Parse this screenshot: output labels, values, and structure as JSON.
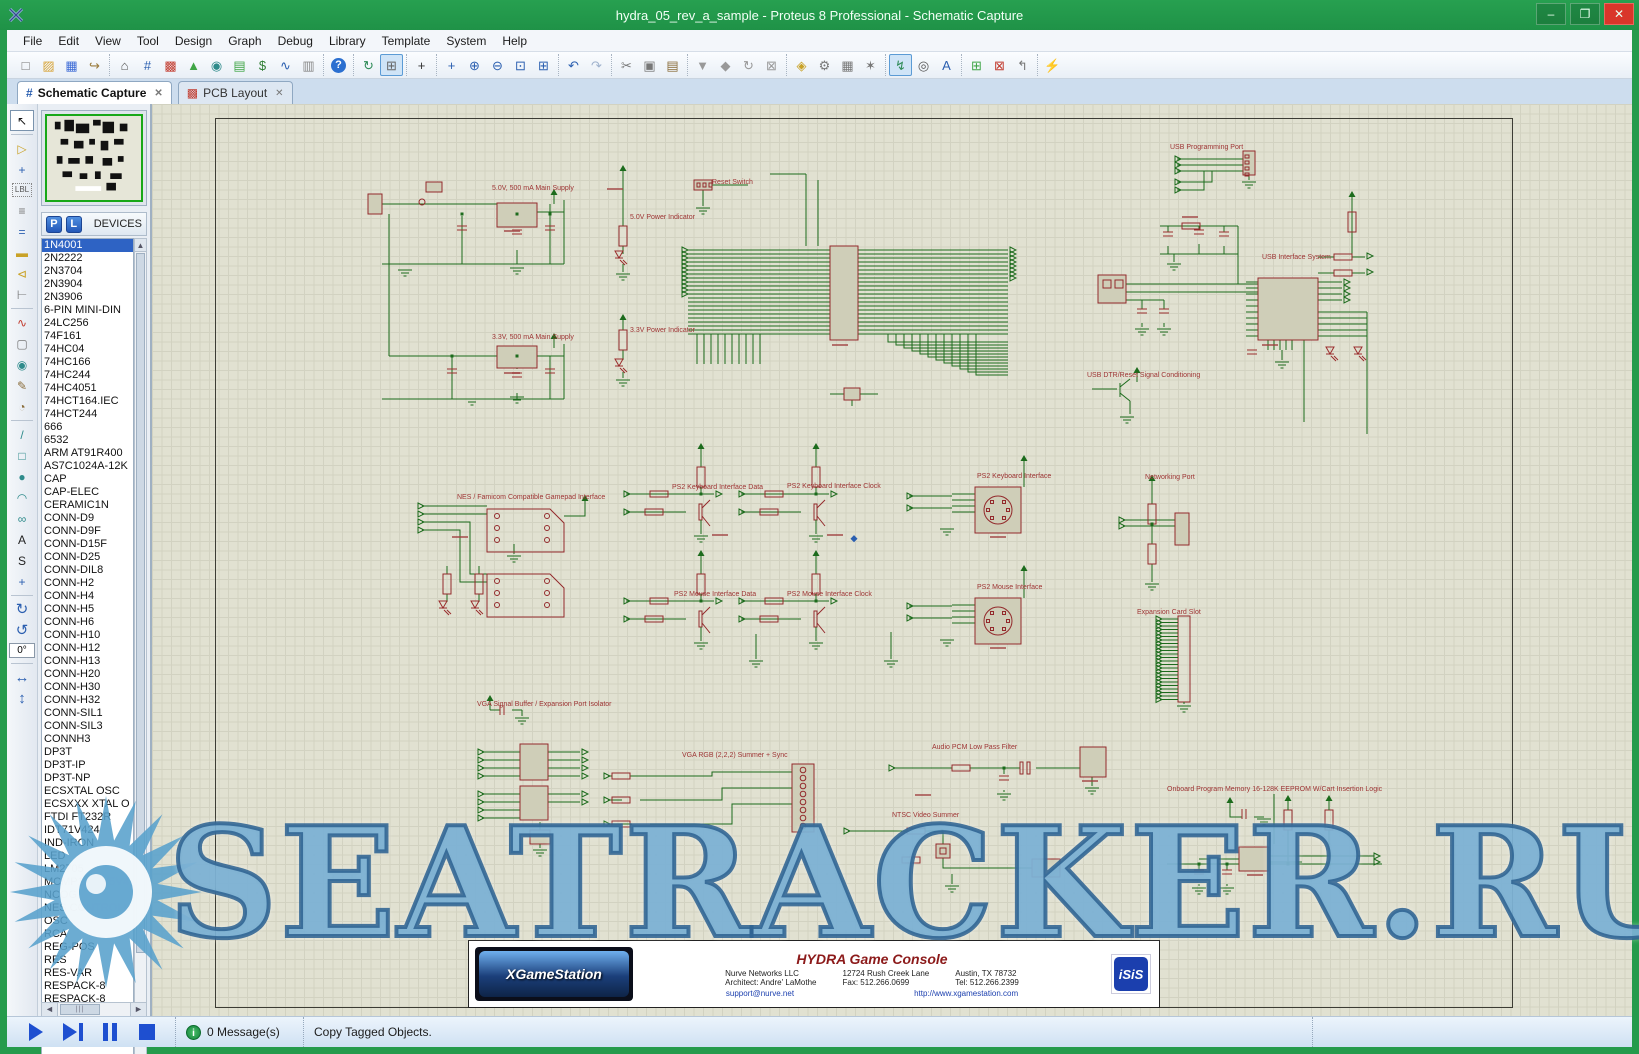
{
  "window": {
    "title": "hydra_05_rev_a_sample - Proteus 8 Professional - Schematic Capture",
    "minimize_glyph": "–",
    "maximize_glyph": "❐",
    "close_glyph": "✕"
  },
  "menu_items": [
    "File",
    "Edit",
    "View",
    "Tool",
    "Design",
    "Graph",
    "Debug",
    "Library",
    "Template",
    "System",
    "Help"
  ],
  "toolbar_groups": [
    {
      "icons": [
        {
          "name": "new-project-icon",
          "glyph": "□",
          "color": "#777"
        },
        {
          "name": "open-project-icon",
          "glyph": "▨",
          "color": "#d8a63c"
        },
        {
          "name": "save-project-icon",
          "glyph": "▦",
          "color": "#3d6bd6"
        },
        {
          "name": "import-project-icon",
          "glyph": "↪",
          "color": "#9a7b3c"
        }
      ]
    },
    {
      "icons": [
        {
          "name": "home-icon",
          "glyph": "⌂",
          "color": "#555"
        },
        {
          "name": "schematic-capture-icon",
          "glyph": "#",
          "color": "#2b5fb0"
        },
        {
          "name": "pcb-layout-icon",
          "glyph": "▩",
          "color": "#c23b2e"
        },
        {
          "name": "3d-visualizer-icon",
          "glyph": "▲",
          "color": "#3fa546"
        },
        {
          "name": "gerber-viewer-icon",
          "glyph": "◉",
          "color": "#2e8b8b"
        },
        {
          "name": "bom-icon",
          "glyph": "▤",
          "color": "#3fa546"
        },
        {
          "name": "bom-cost-icon",
          "glyph": "$",
          "color": "#2e7d32"
        },
        {
          "name": "simulation-icon",
          "glyph": "∿",
          "color": "#2b5fb0"
        },
        {
          "name": "design-explorer-icon",
          "glyph": "▥",
          "color": "#888"
        }
      ]
    },
    {
      "icons": [
        {
          "name": "help-icon",
          "glyph": "?",
          "color": "#fff",
          "help": true
        }
      ]
    },
    {
      "icons": [
        {
          "name": "redraw-icon",
          "glyph": "↻",
          "color": "#2e8b57"
        },
        {
          "name": "grid-toggle-icon",
          "glyph": "⊞",
          "color": "#666",
          "pressed": true
        }
      ]
    },
    {
      "icons": [
        {
          "name": "origin-icon",
          "glyph": "+",
          "color": "#333"
        }
      ]
    },
    {
      "icons": [
        {
          "name": "pan-icon",
          "glyph": "+",
          "color": "#2b5fb0"
        },
        {
          "name": "zoom-in-icon",
          "glyph": "⊕",
          "color": "#2b5fb0"
        },
        {
          "name": "zoom-out-icon",
          "glyph": "⊖",
          "color": "#2b5fb0"
        },
        {
          "name": "zoom-area-icon",
          "glyph": "⊡",
          "color": "#2b5fb0"
        },
        {
          "name": "zoom-all-icon",
          "glyph": "⊞",
          "color": "#2b5fb0"
        }
      ]
    },
    {
      "icons": [
        {
          "name": "undo-icon",
          "glyph": "↶",
          "color": "#2b5fb0"
        },
        {
          "name": "redo-icon",
          "glyph": "↷",
          "color": "#9fb2cd"
        }
      ]
    },
    {
      "icons": [
        {
          "name": "cut-icon",
          "glyph": "✂",
          "color": "#777"
        },
        {
          "name": "copy-icon",
          "glyph": "▣",
          "color": "#777"
        },
        {
          "name": "paste-icon",
          "glyph": "▤",
          "color": "#8a6d3b"
        }
      ]
    },
    {
      "icons": [
        {
          "name": "block-copy-icon",
          "glyph": "▼",
          "color": "#999"
        },
        {
          "name": "block-move-icon",
          "glyph": "◆",
          "color": "#999"
        },
        {
          "name": "block-rotate-icon",
          "glyph": "↻",
          "color": "#999"
        },
        {
          "name": "block-delete-icon",
          "glyph": "⊠",
          "color": "#999"
        }
      ]
    },
    {
      "icons": [
        {
          "name": "pick-parts-icon",
          "glyph": "◈",
          "color": "#c9a227"
        },
        {
          "name": "make-device-icon",
          "glyph": "⚙",
          "color": "#777"
        },
        {
          "name": "packaging-tool-icon",
          "glyph": "▦",
          "color": "#777"
        },
        {
          "name": "decompose-icon",
          "glyph": "✶",
          "color": "#777"
        }
      ]
    },
    {
      "icons": [
        {
          "name": "wire-autorouter-icon",
          "glyph": "↯",
          "color": "#2e8b57",
          "pressed": true
        },
        {
          "name": "search-tag-icon",
          "glyph": "◎",
          "color": "#555"
        },
        {
          "name": "property-assignment-icon",
          "glyph": "A",
          "color": "#2b5fb0"
        }
      ]
    },
    {
      "icons": [
        {
          "name": "new-sheet-icon",
          "glyph": "⊞",
          "color": "#3fa546"
        },
        {
          "name": "remove-sheet-icon",
          "glyph": "⊠",
          "color": "#c23b2e"
        },
        {
          "name": "exit-to-parent-icon",
          "glyph": "↰",
          "color": "#777"
        }
      ]
    },
    {
      "icons": [
        {
          "name": "erc-icon",
          "glyph": "⚡",
          "color": "#2b5fb0"
        }
      ]
    }
  ],
  "tabs": [
    {
      "name": "tab-schematic-capture",
      "label": "Schematic Capture",
      "icon_glyph": "#",
      "icon_color": "#2b5fb0",
      "active": true
    },
    {
      "name": "tab-pcb-layout",
      "label": "PCB Layout",
      "icon_glyph": "▩",
      "icon_color": "#c23b2e",
      "active": false
    }
  ],
  "close_tab_glyph": "✕",
  "left_modes": [
    {
      "name": "selection-mode",
      "glyph": "↖",
      "color": "#111",
      "active": true
    },
    {
      "name": "component-mode",
      "glyph": "▷",
      "color": "#c9a227"
    },
    {
      "name": "junction-dot-mode",
      "glyph": "+",
      "color": "#2b5fb0"
    },
    {
      "name": "wire-label-mode",
      "glyph": "LBL",
      "color": "#555"
    },
    {
      "name": "text-script-mode",
      "glyph": "≡",
      "color": "#777"
    },
    {
      "name": "buses-mode",
      "glyph": "=",
      "color": "#2b5fb0"
    },
    {
      "name": "subcircuit-mode",
      "glyph": "▬",
      "color": "#c9a227"
    },
    {
      "name": "terminals-mode",
      "glyph": "⊲",
      "color": "#c9a227"
    },
    {
      "name": "device-pins-mode",
      "glyph": "⊢",
      "color": "#777"
    },
    {
      "name": "graph-mode",
      "glyph": "∿",
      "color": "#c23b2e"
    },
    {
      "name": "tape-recorder-mode",
      "glyph": "▢",
      "color": "#777"
    },
    {
      "name": "generator-mode",
      "glyph": "◉",
      "color": "#2e8b8b"
    },
    {
      "name": "voltage-probe-mode",
      "glyph": "✎",
      "color": "#8a6d3b"
    },
    {
      "name": "current-probe-mode",
      "glyph": "◔",
      "color": "#8a6d3b"
    },
    {
      "name": "line-2d-mode",
      "glyph": "/",
      "color": "#2e8b8b"
    },
    {
      "name": "box-2d-mode",
      "glyph": "□",
      "color": "#2e8b8b"
    },
    {
      "name": "circle-2d-mode",
      "glyph": "●",
      "color": "#2e8b8b"
    },
    {
      "name": "arc-2d-mode",
      "glyph": "◠",
      "color": "#2e8b8b"
    },
    {
      "name": "path-2d-mode",
      "glyph": "∞",
      "color": "#2e8b8b"
    },
    {
      "name": "text-2d-mode",
      "glyph": "A",
      "color": "#222"
    },
    {
      "name": "symbol-2d-mode",
      "glyph": "S",
      "color": "#222"
    },
    {
      "name": "marker-2d-mode",
      "glyph": "+",
      "color": "#2b5fb0"
    }
  ],
  "rotation": {
    "cw_glyph": "↻",
    "ccw_glyph": "↺",
    "angle": "0°",
    "flip_h_glyph": "↔",
    "flip_v_glyph": "↕"
  },
  "devices_panel": {
    "p_button": "P",
    "l_button": "L",
    "header": "DEVICES",
    "selected_index": 0,
    "devices": [
      "1N4001",
      "2N2222",
      "2N3704",
      "2N3904",
      "2N3906",
      "6-PIN MINI-DIN",
      "24LC256",
      "74F161",
      "74HC04",
      "74HC166",
      "74HC244",
      "74HC4051",
      "74HCT164.IEC",
      "74HCT244",
      "666",
      "6532",
      "ARM AT91R400",
      "AS7C1024A-12K",
      "CAP",
      "CAP-ELEC",
      "CERAMIC1N",
      "CONN-D9",
      "CONN-D9F",
      "CONN-D15F",
      "CONN-D25",
      "CONN-DIL8",
      "CONN-H2",
      "CONN-H4",
      "CONN-H5",
      "CONN-H6",
      "CONN-H10",
      "CONN-H12",
      "CONN-H13",
      "CONN-H20",
      "CONN-H30",
      "CONN-H32",
      "CONN-SIL1",
      "CONN-SIL3",
      "CONNH3",
      "DP3T",
      "DP3T-IP",
      "DP3T-NP",
      "ECSXTAL OSC",
      "ECSXXX XTAL O",
      "FTDI FT232R",
      "IDT71V424",
      "IND-IRON",
      "LED",
      "LM2705",
      "MCMP1206Y5V4",
      "NCOG",
      "NES CONTROLL",
      "OSC",
      "RCA",
      "REG-POS",
      "RES",
      "RES-VAR",
      "RESPACK-8",
      "RESPACK-8"
    ]
  },
  "schematic": {
    "section_labels": [
      {
        "text": "5.0V, 500 mA Main Supply",
        "x": 340,
        "y": 81
      },
      {
        "text": "5.0V Power Indicator",
        "x": 478,
        "y": 110
      },
      {
        "text": "Reset Switch",
        "x": 560,
        "y": 75
      },
      {
        "text": "3.3V, 500 mA Main Supply",
        "x": 340,
        "y": 230
      },
      {
        "text": "3.3V Power Indicator",
        "x": 478,
        "y": 223
      },
      {
        "text": "USB Programming Port",
        "x": 1018,
        "y": 40
      },
      {
        "text": "USB Interface System",
        "x": 1110,
        "y": 150
      },
      {
        "text": "USB DTR/Reset Signal Conditioning",
        "x": 935,
        "y": 268
      },
      {
        "text": "PS2 Keyboard Interface Data",
        "x": 520,
        "y": 380
      },
      {
        "text": "PS2 Keyboard Interface Clock",
        "x": 635,
        "y": 379
      },
      {
        "text": "PS2 Keyboard Interface",
        "x": 825,
        "y": 369
      },
      {
        "text": "Networking Port",
        "x": 993,
        "y": 370
      },
      {
        "text": "NES / Famicom Compatible Gamepad Interface",
        "x": 305,
        "y": 390
      },
      {
        "text": "PS2 Mouse Interface Data",
        "x": 522,
        "y": 487
      },
      {
        "text": "PS2 Mouse Interface Clock",
        "x": 635,
        "y": 487
      },
      {
        "text": "PS2 Mouse Interface",
        "x": 825,
        "y": 480
      },
      {
        "text": "Expansion Card Slot",
        "x": 985,
        "y": 505
      },
      {
        "text": "VGA Signal Buffer / Expansion Port Isolator",
        "x": 325,
        "y": 597
      },
      {
        "text": "VGA RGB (2,2,2) Summer + Sync",
        "x": 530,
        "y": 648
      },
      {
        "text": "Audio PCM  Low Pass Filter",
        "x": 780,
        "y": 640
      },
      {
        "text": "NTSC Video Summer",
        "x": 740,
        "y": 708
      },
      {
        "text": "Onboard Program Memory 16-128K EEPROM W/Cart Insertion Logic",
        "x": 1015,
        "y": 682
      }
    ],
    "title_block": {
      "title": "HYDRA Game Console",
      "company": "Nurve Networks LLC",
      "address1": "12724 Rush Creek Lane",
      "address2": "Austin, TX 78732",
      "architect": "Architect: Andre' LaMothe",
      "fax": "Fax: 512.266.0699",
      "tel": "Tel: 512.266.2399",
      "email": "support@nurve.net",
      "website": "http://www.xgamestation.com",
      "logo_left": "XGameStation",
      "logo_right": "iSiS"
    },
    "watermark_text": "SEATRACKER.RU"
  },
  "statusbar": {
    "messages": "0 Message(s)",
    "status": "Copy Tagged Objects."
  }
}
